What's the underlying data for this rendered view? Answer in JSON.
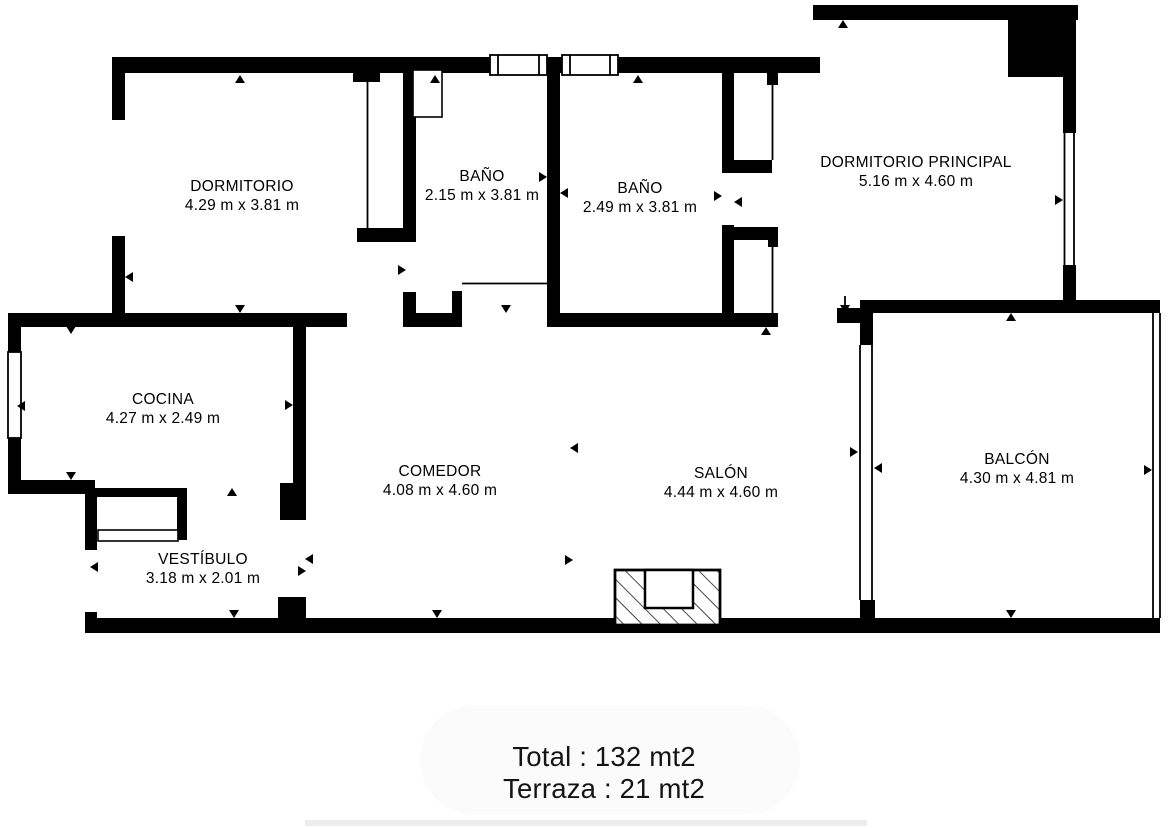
{
  "floor_plan": {
    "rooms": [
      {
        "id": "dormitorio",
        "name": "DORMITORIO",
        "dims": "4.29 m x 3.81 m"
      },
      {
        "id": "bano-1",
        "name": "BAÑO",
        "dims": "2.15 m x 3.81 m"
      },
      {
        "id": "bano-2",
        "name": "BAÑO",
        "dims": "2.49 m x 3.81 m"
      },
      {
        "id": "dormitorio-principal",
        "name": "DORMITORIO PRINCIPAL",
        "dims": "5.16 m x 4.60 m"
      },
      {
        "id": "cocina",
        "name": "COCINA",
        "dims": "4.27 m x 2.49 m"
      },
      {
        "id": "comedor",
        "name": "COMEDOR",
        "dims": "4.08 m x 4.60 m"
      },
      {
        "id": "salon",
        "name": "SALÓN",
        "dims": "4.44 m x 4.60 m"
      },
      {
        "id": "balcon",
        "name": "BALCÓN",
        "dims": "4.30 m x 4.81 m"
      },
      {
        "id": "vestibulo",
        "name": "VESTÍBULO",
        "dims": "3.18 m x 2.01 m"
      }
    ],
    "summary": {
      "total": "Total : 132 mt2",
      "terraza": "Terraza : 21 mt2"
    },
    "colors": {
      "wall": "#000000",
      "background": "#ffffff"
    }
  }
}
